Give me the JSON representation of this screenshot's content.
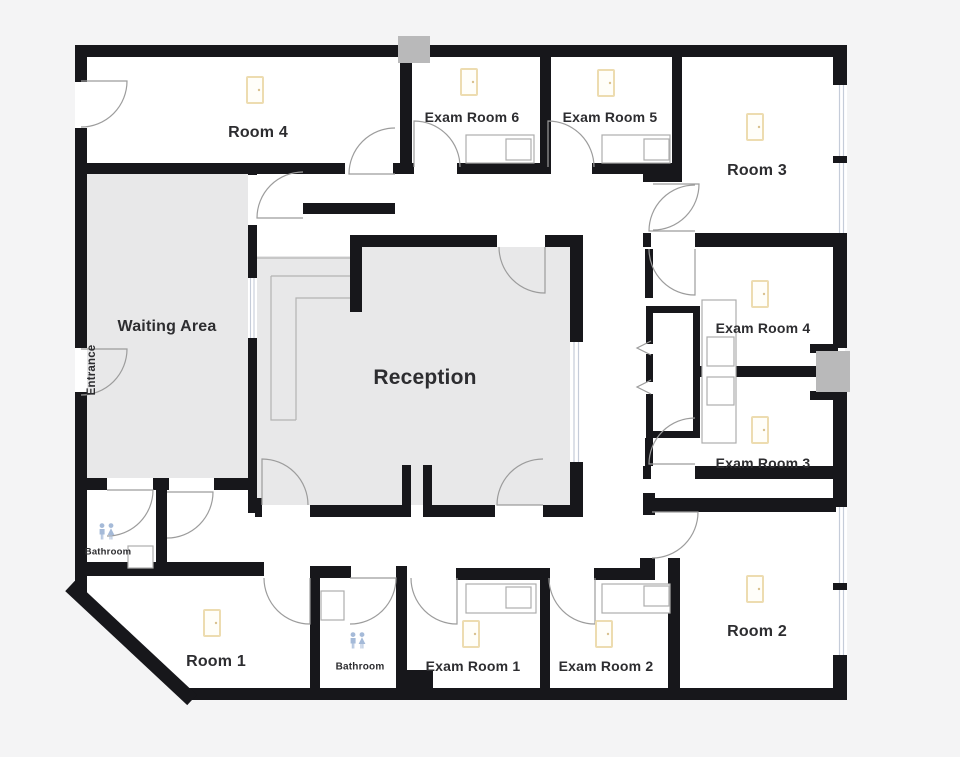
{
  "plan": {
    "title": "Medical office floor plan",
    "rooms": {
      "room4": "Room 4",
      "exam6": "Exam Room 6",
      "exam5": "Exam Room 5",
      "room3": "Room 3",
      "waiting": "Waiting Area",
      "reception": "Reception",
      "exam4": "Exam Room 4",
      "exam3": "Exam Room 3",
      "bathroom1": "Bathroom",
      "room1": "Room 1",
      "bathroom2": "Bathroom",
      "exam1": "Exam Room 1",
      "exam2": "Exam Room 2",
      "room2": "Room 2",
      "entrance": "Entrance"
    },
    "icons": {
      "light_icon": "light-icon",
      "restroom_icon": "restroom-icon",
      "door_arc": "door-swing-arc",
      "window": "window",
      "sink": "sink",
      "counter": "counter"
    },
    "colors": {
      "background": "#f4f4f5",
      "wall": "#17171b",
      "floor": "#ffffff",
      "shaded_room": "#e8e8e9",
      "door_arc": "#9c9c9c",
      "window": "#c5ccd9",
      "light_icon": "#eddcb0",
      "restroom_icon": "#a5bad8",
      "exterior_block": "#b9b9ba",
      "label": "#2d2d30"
    }
  }
}
